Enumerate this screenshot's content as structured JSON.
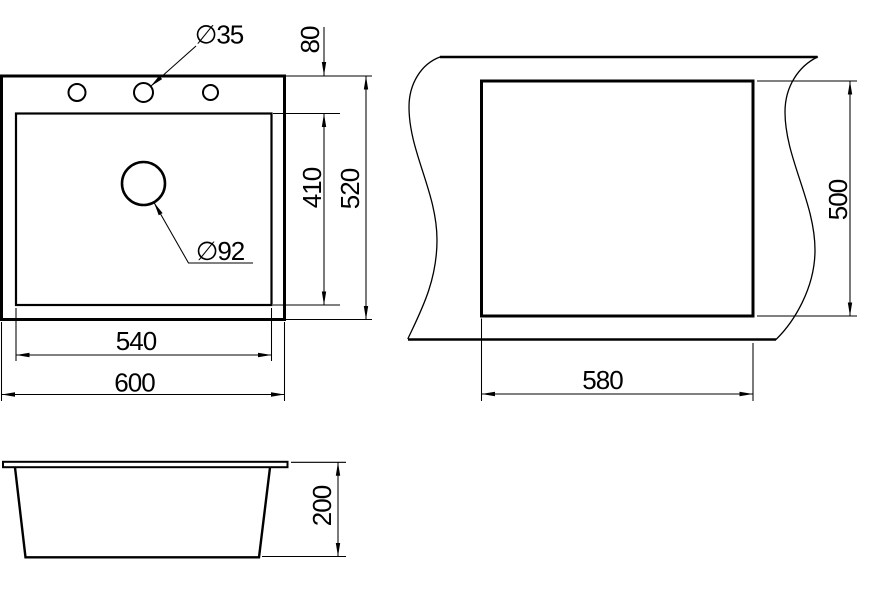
{
  "drawing": {
    "kind": "sink-installation-technical-drawing",
    "colors": {
      "ink": "#000000",
      "paper": "#ffffff"
    },
    "views": {
      "top": {
        "dimensions": {
          "tap_hole_diameter": "∅35",
          "drain_hole_diameter": "∅92",
          "rim_to_bowl": "80",
          "bowl_depth": "410",
          "overall_depth": "520",
          "bowl_width": "540",
          "overall_width": "600"
        }
      },
      "cutout": {
        "dimensions": {
          "cutout_depth": "500",
          "cutout_width": "580"
        }
      },
      "side": {
        "dimensions": {
          "overall_height": "200"
        }
      }
    }
  }
}
